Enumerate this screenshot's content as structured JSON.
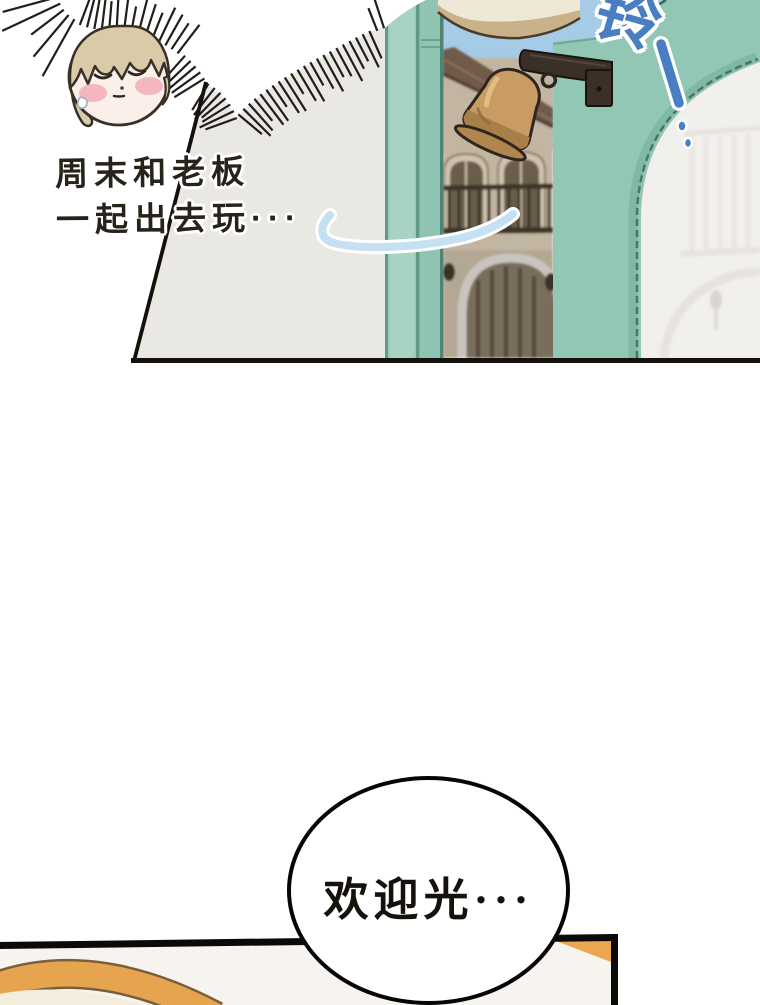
{
  "comic": {
    "panel_top": {
      "narration": {
        "line1": "周末和老板",
        "line2": "一起出去玩···"
      },
      "sfx": {
        "bell_sound": "铃"
      }
    },
    "speech_bubble": {
      "text": "欢迎光···"
    },
    "colors": {
      "door_frame_teal": "#92C7B5",
      "teal_shadow_line": "#5D9884",
      "interior_wall_grey": "#EAE8E3",
      "sky_blue": "#A6CBE7",
      "bell_brass": "#C89C62",
      "bracket_dark": "#3A3027",
      "sfx_blue": "#4A7EC2",
      "swoosh_blue": "#C5DFF3",
      "hair_tan": "#DACBA8",
      "blush_pink": "#F3AFBA",
      "orange_accent": "#E9A750",
      "bottom_panel_bg": "#F7F4EF",
      "ink_black": "#17130E"
    }
  }
}
